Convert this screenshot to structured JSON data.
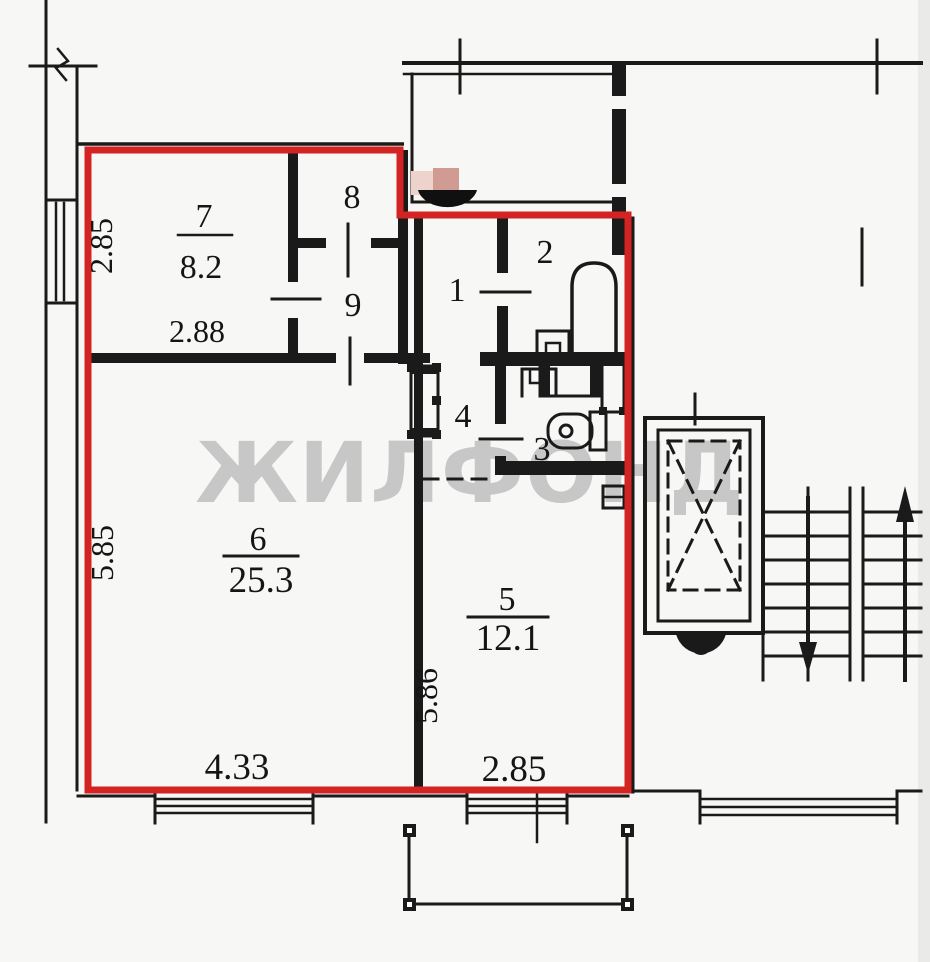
{
  "watermark": "ЖИЛФОНД",
  "colors": {
    "walls": "#1a1a1a",
    "outline": "#d42323",
    "watermark": "#c7c7c7",
    "background": "#f7f7f5",
    "blur_light": "#eed3cc",
    "blur_dark": "#cf9b93"
  },
  "rooms": {
    "r1": {
      "num": "1"
    },
    "r2": {
      "num": "2"
    },
    "r3": {
      "num": "3"
    },
    "r4": {
      "num": "4"
    },
    "r5": {
      "num": "5",
      "area": "12.1",
      "width": "2.85",
      "height": "5.86"
    },
    "r6": {
      "num": "6",
      "area": "25.3",
      "width": "4.33",
      "height": "5.85"
    },
    "r7": {
      "num": "7",
      "area": "8.2",
      "width": "2.88",
      "height": "2.85"
    },
    "r8": {
      "num": "8"
    },
    "r9": {
      "num": "9"
    }
  }
}
